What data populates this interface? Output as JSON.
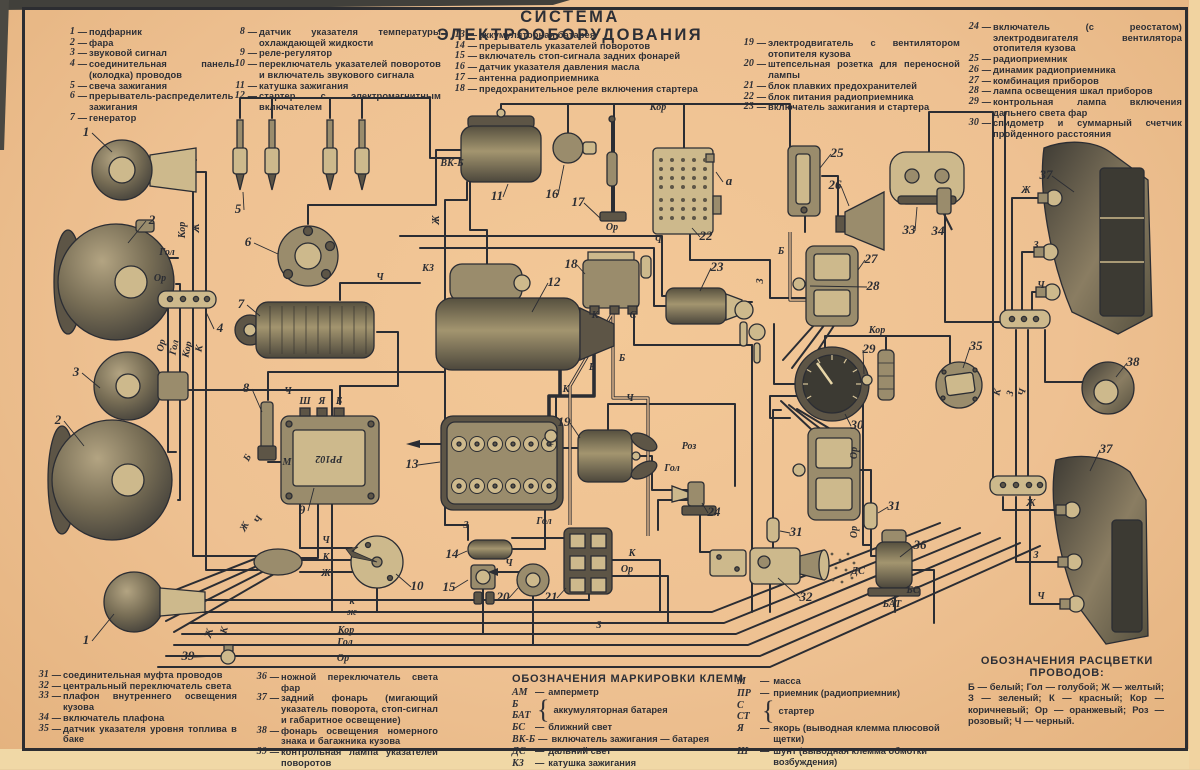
{
  "title": "СИСТЕМА ЭЛЕКТРООБОРУДОВАНИЯ",
  "colors": {
    "paper": "#eec192",
    "ink": "#2c2e34",
    "edge_dark": "#41403b",
    "edge_light": "#f0d8a6"
  },
  "legend_top": [
    [
      {
        "n": "1",
        "t": "подфарник"
      },
      {
        "n": "2",
        "t": "фара"
      },
      {
        "n": "3",
        "t": "звуковой сигнал"
      },
      {
        "n": "4",
        "t": "соединительная панель (колодка) проводов"
      },
      {
        "n": "5",
        "t": "свеча зажигания"
      },
      {
        "n": "6",
        "t": "прерыватель-распределитель зажигания"
      },
      {
        "n": "7",
        "t": "генератор"
      }
    ],
    [
      {
        "n": "8",
        "t": "датчик указателя температуры охлаждающей жидкости"
      },
      {
        "n": "9",
        "t": "реле-регулятор"
      },
      {
        "n": "10",
        "t": "переключатель указателей поворотов и включатель звукового сигнала"
      },
      {
        "n": "11",
        "t": "катушка зажигания"
      },
      {
        "n": "12",
        "t": "стартер с электромагнитным включателем"
      }
    ],
    [
      {
        "n": "13",
        "t": "аккумуляторная батарея"
      },
      {
        "n": "14",
        "t": "прерыватель указателей поворотов"
      },
      {
        "n": "15",
        "t": "включатель стоп-сигнала задних фонарей"
      },
      {
        "n": "16",
        "t": "датчик указателя давления масла"
      },
      {
        "n": "17",
        "t": "антенна радиоприемника"
      },
      {
        "n": "18",
        "t": "предохранительное реле включения стартера"
      }
    ],
    [
      {
        "n": "19",
        "t": "электродвигатель с вентилятором отопителя кузова"
      },
      {
        "n": "20",
        "t": "штепсельная розетка для переносной лампы"
      },
      {
        "n": "21",
        "t": "блок плавких предохранителей"
      },
      {
        "n": "22",
        "t": "блок питания радиоприемника"
      },
      {
        "n": "23",
        "t": "включатель зажигания и стартера"
      }
    ],
    [
      {
        "n": "24",
        "t": "включатель (с реостатом) электродвигателя вентилятора отопителя кузова"
      },
      {
        "n": "25",
        "t": "радиоприемник"
      },
      {
        "n": "26",
        "t": "динамик радиоприемника"
      },
      {
        "n": "27",
        "t": "комбинация приборов"
      },
      {
        "n": "28",
        "t": "лампа освещения шкал приборов"
      },
      {
        "n": "29",
        "t": "контрольная лампа включения дальнего света фар"
      },
      {
        "n": "30",
        "t": "спидометр и суммарный счетчик пройденного расстояния"
      }
    ]
  ],
  "legend_bottom": [
    [
      {
        "n": "31",
        "t": "соединительная муфта проводов"
      },
      {
        "n": "32",
        "t": "центральный переключатель света"
      },
      {
        "n": "33",
        "t": "плафон внутреннего освещения кузова"
      },
      {
        "n": "34",
        "t": "включатель плафона"
      },
      {
        "n": "35",
        "t": "датчик указателя уровня топлива в баке"
      }
    ],
    [
      {
        "n": "36",
        "t": "ножной переключатель света фар"
      },
      {
        "n": "37",
        "t": "задний фонарь (мигающий указатель поворота, стоп-сигнал и габаритное освещение)"
      },
      {
        "n": "38",
        "t": "фонарь освещения номерного знака и багажника кузова"
      },
      {
        "n": "39",
        "t": "контрольная лампа указателей поворотов"
      }
    ]
  ],
  "terminals": {
    "heading": "ОБОЗНАЧЕНИЯ МАРКИРОВКИ КЛЕММ",
    "col1": [
      {
        "a": "АМ",
        "t": "амперметр"
      },
      {
        "a": "Б|БАТ",
        "t": "аккумуляторная батарея",
        "b": true
      },
      {
        "a": "БС",
        "t": "ближний свет"
      },
      {
        "a": "ВК-Б",
        "t": "включатель зажигания — батарея"
      },
      {
        "a": "ДС",
        "t": "дальний свет"
      },
      {
        "a": "КЗ",
        "t": "катушка зажигания"
      }
    ],
    "col2": [
      {
        "a": "М",
        "t": "масса"
      },
      {
        "a": "ПР",
        "t": "приемник (радиоприемник)"
      },
      {
        "a": "С|СТ",
        "t": "стартер",
        "b": true
      },
      {
        "a": "Я",
        "t": "якорь (выводная клемма плюсовой щетки)"
      },
      {
        "a": "Ш",
        "t": "шунт (выводная клемма обмотки возбуждения)"
      }
    ]
  },
  "wire_colors": {
    "heading1": "ОБОЗНАЧЕНИЯ РАСЦВЕТКИ",
    "heading2": "ПРОВОДОВ:",
    "body": "Б — белый;  Гол — голубой;  Ж — желтый; З — зеленый;  К — красный;  Кор — коричневый;  Ор — оранжевый;  Роз — розовый; Ч — черный."
  },
  "diagram": {
    "callouts": [
      {
        "n": "1",
        "x": 86,
        "y": 136,
        "lx": 112,
        "ly": 152
      },
      {
        "n": "2",
        "x": 152,
        "y": 224,
        "lx": 128,
        "ly": 243
      },
      {
        "n": "3",
        "x": 76,
        "y": 376,
        "lx": 100,
        "ly": 388
      },
      {
        "n": "2",
        "x": 58,
        "y": 424,
        "lx": 84,
        "ly": 446
      },
      {
        "n": "1",
        "x": 86,
        "y": 644,
        "lx": 114,
        "ly": 614
      },
      {
        "n": "39",
        "x": 188,
        "y": 660,
        "lx": 218,
        "ly": 656
      },
      {
        "n": "4",
        "x": 220,
        "y": 332,
        "lx": 206,
        "ly": 312
      },
      {
        "n": "5",
        "x": 238,
        "y": 213,
        "lx": 243,
        "ly": 192
      },
      {
        "n": "6",
        "x": 248,
        "y": 246,
        "lx": 278,
        "ly": 254
      },
      {
        "n": "7",
        "x": 241,
        "y": 308,
        "lx": 260,
        "ly": 316
      },
      {
        "n": "8",
        "x": 246,
        "y": 392,
        "lx": 262,
        "ly": 412
      },
      {
        "n": "9",
        "x": 302,
        "y": 514,
        "lx": 314,
        "ly": 488
      },
      {
        "n": "10",
        "x": 417,
        "y": 590,
        "lx": 396,
        "ly": 574
      },
      {
        "n": "11",
        "x": 497,
        "y": 200,
        "lx": 508,
        "ly": 184
      },
      {
        "n": "12",
        "x": 554,
        "y": 286,
        "lx": 532,
        "ly": 312
      },
      {
        "n": "13",
        "x": 412,
        "y": 468,
        "lx": 440,
        "ly": 462
      },
      {
        "n": "14",
        "x": 452,
        "y": 558,
        "lx": 467,
        "ly": 551
      },
      {
        "n": "15",
        "x": 449,
        "y": 591,
        "lx": 468,
        "ly": 580
      },
      {
        "n": "16",
        "x": 552,
        "y": 198,
        "lx": 564,
        "ly": 165
      },
      {
        "n": "17",
        "x": 578,
        "y": 206,
        "lx": 600,
        "ly": 218
      },
      {
        "n": "18",
        "x": 571,
        "y": 268,
        "lx": 585,
        "ly": 274
      },
      {
        "n": "19",
        "x": 564,
        "y": 426,
        "lx": 580,
        "ly": 438
      },
      {
        "n": "20",
        "x": 503,
        "y": 601,
        "lx": 518,
        "ly": 588
      },
      {
        "n": "21",
        "x": 551,
        "y": 601,
        "lx": 566,
        "ly": 588
      },
      {
        "n": "22",
        "x": 706,
        "y": 240,
        "lx": 692,
        "ly": 228
      },
      {
        "n": "23",
        "x": 717,
        "y": 271,
        "lx": 700,
        "ly": 291
      },
      {
        "n": "24",
        "x": 714,
        "y": 516,
        "lx": 702,
        "ly": 503
      },
      {
        "n": "25",
        "x": 837,
        "y": 157,
        "lx": 820,
        "ly": 168
      },
      {
        "n": "26",
        "x": 835,
        "y": 189,
        "lx": 849,
        "ly": 206
      },
      {
        "n": "27",
        "x": 871,
        "y": 263,
        "lx": 858,
        "ly": 270
      },
      {
        "n": "28",
        "x": 873,
        "y": 290,
        "lx": 810,
        "ly": 286
      },
      {
        "n": "29",
        "x": 869,
        "y": 353,
        "lx": 864,
        "ly": 374
      },
      {
        "n": "30",
        "x": 857,
        "y": 429,
        "lx": 845,
        "ly": 414
      },
      {
        "n": "31",
        "x": 796,
        "y": 536,
        "lx": 780,
        "ly": 531
      },
      {
        "n": "31",
        "x": 894,
        "y": 510,
        "lx": 878,
        "ly": 513
      },
      {
        "n": "32",
        "x": 806,
        "y": 601,
        "lx": 778,
        "ly": 578
      },
      {
        "n": "33",
        "x": 909,
        "y": 234,
        "lx": 917,
        "ly": 207
      },
      {
        "n": "34",
        "x": 938,
        "y": 235,
        "lx": 946,
        "ly": 217
      },
      {
        "n": "35",
        "x": 976,
        "y": 350,
        "lx": 963,
        "ly": 368
      },
      {
        "n": "36",
        "x": 920,
        "y": 549,
        "lx": 900,
        "ly": 557
      },
      {
        "n": "37",
        "x": 1046,
        "y": 179,
        "lx": 1074,
        "ly": 192
      },
      {
        "n": "37",
        "x": 1106,
        "y": 453,
        "lx": 1090,
        "ly": 471
      },
      {
        "n": "38",
        "x": 1133,
        "y": 366,
        "lx": 1116,
        "ly": 377
      },
      {
        "n": "а",
        "x": 729,
        "y": 185,
        "lx": 716,
        "ly": 172
      }
    ],
    "wire_labels": [
      {
        "t": "Кор",
        "x": 658,
        "y": 110
      },
      {
        "t": "Кор",
        "x": 185,
        "y": 230,
        "r": -90
      },
      {
        "t": "Ж",
        "x": 199,
        "y": 228,
        "r": -90
      },
      {
        "t": "Гол",
        "x": 167,
        "y": 255
      },
      {
        "t": "Ор",
        "x": 160,
        "y": 281
      },
      {
        "t": "Ор",
        "x": 164,
        "y": 346,
        "r": -78
      },
      {
        "t": "Гол",
        "x": 177,
        "y": 348,
        "r": -78
      },
      {
        "t": "Кор",
        "x": 190,
        "y": 350,
        "r": -78
      },
      {
        "t": "К",
        "x": 202,
        "y": 349,
        "r": -78
      },
      {
        "t": "Ж",
        "x": 439,
        "y": 220,
        "r": -90
      },
      {
        "t": "Ч",
        "x": 380,
        "y": 280
      },
      {
        "t": "КЗ",
        "x": 428,
        "y": 271,
        "s": 8
      },
      {
        "t": "ВК-Б",
        "x": 452,
        "y": 166,
        "s": 7
      },
      {
        "t": "Ор",
        "x": 612,
        "y": 230
      },
      {
        "t": "Ч",
        "x": 658,
        "y": 243
      },
      {
        "t": "Б",
        "x": 781,
        "y": 254
      },
      {
        "t": "З",
        "x": 763,
        "y": 281,
        "r": -90
      },
      {
        "t": "К",
        "x": 566,
        "y": 392
      },
      {
        "t": "Б",
        "x": 592,
        "y": 370
      },
      {
        "t": "Б",
        "x": 622,
        "y": 361
      },
      {
        "t": "Ш",
        "x": 305,
        "y": 404,
        "s": 8
      },
      {
        "t": "Я",
        "x": 322,
        "y": 404,
        "s": 8
      },
      {
        "t": "Б",
        "x": 339,
        "y": 404,
        "s": 8
      },
      {
        "t": "М",
        "x": 287,
        "y": 465,
        "s": 8
      },
      {
        "t": "РР102",
        "x": 329,
        "y": 456,
        "r": 180,
        "s": 13
      },
      {
        "t": "Ч",
        "x": 288,
        "y": 394
      },
      {
        "t": "+",
        "x": 551,
        "y": 448,
        "s": 11
      },
      {
        "t": "К",
        "x": 595,
        "y": 318,
        "s": 8
      },
      {
        "t": "С",
        "x": 633,
        "y": 318,
        "s": 8
      },
      {
        "t": "Ч",
        "x": 326,
        "y": 543
      },
      {
        "t": "К",
        "x": 326,
        "y": 560
      },
      {
        "t": "Ж",
        "x": 326,
        "y": 576
      },
      {
        "t": "к",
        "x": 352,
        "y": 604,
        "s": 9
      },
      {
        "t": "ж",
        "x": 352,
        "y": 615,
        "s": 9
      },
      {
        "t": "Кор",
        "x": 346,
        "y": 633,
        "s": 9
      },
      {
        "t": "Гол",
        "x": 345,
        "y": 645,
        "s": 9
      },
      {
        "t": "Ор",
        "x": 343,
        "y": 661,
        "s": 9
      },
      {
        "t": "Ж",
        "x": 212,
        "y": 634,
        "r": -75
      },
      {
        "t": "К",
        "x": 227,
        "y": 631,
        "r": -75
      },
      {
        "t": "Б",
        "x": 250,
        "y": 459,
        "r": -62
      },
      {
        "t": "Ж",
        "x": 247,
        "y": 528,
        "r": -62
      },
      {
        "t": "Ч",
        "x": 261,
        "y": 521,
        "r": -62
      },
      {
        "t": "З",
        "x": 466,
        "y": 528
      },
      {
        "t": "Гол",
        "x": 544,
        "y": 524
      },
      {
        "t": "Ч",
        "x": 509,
        "y": 566
      },
      {
        "t": "К",
        "x": 632,
        "y": 556
      },
      {
        "t": "Ор",
        "x": 627,
        "y": 572
      },
      {
        "t": "З",
        "x": 599,
        "y": 628
      },
      {
        "t": "Ч",
        "x": 630,
        "y": 401
      },
      {
        "t": "Роз",
        "x": 689,
        "y": 449
      },
      {
        "t": "Гол",
        "x": 672,
        "y": 471
      },
      {
        "t": "Ор",
        "x": 857,
        "y": 453,
        "r": -90
      },
      {
        "t": "Ор",
        "x": 857,
        "y": 532,
        "r": -90
      },
      {
        "t": "Кор",
        "x": 877,
        "y": 333
      },
      {
        "t": "ДС",
        "x": 858,
        "y": 574,
        "s": 8
      },
      {
        "t": "БС",
        "x": 913,
        "y": 593,
        "s": 8
      },
      {
        "t": "БАТ",
        "x": 892,
        "y": 607,
        "s": 8
      },
      {
        "t": "Ж",
        "x": 1026,
        "y": 193
      },
      {
        "t": "З",
        "x": 1036,
        "y": 248
      },
      {
        "t": "Ч",
        "x": 1041,
        "y": 288
      },
      {
        "t": "Ж",
        "x": 1031,
        "y": 506
      },
      {
        "t": "З",
        "x": 1036,
        "y": 558
      },
      {
        "t": "Ч",
        "x": 1041,
        "y": 599
      },
      {
        "t": "К",
        "x": 1000,
        "y": 393,
        "r": -75
      },
      {
        "t": "З",
        "x": 1013,
        "y": 394,
        "r": -75
      },
      {
        "t": "Ч",
        "x": 1025,
        "y": 393,
        "r": -75
      }
    ]
  }
}
